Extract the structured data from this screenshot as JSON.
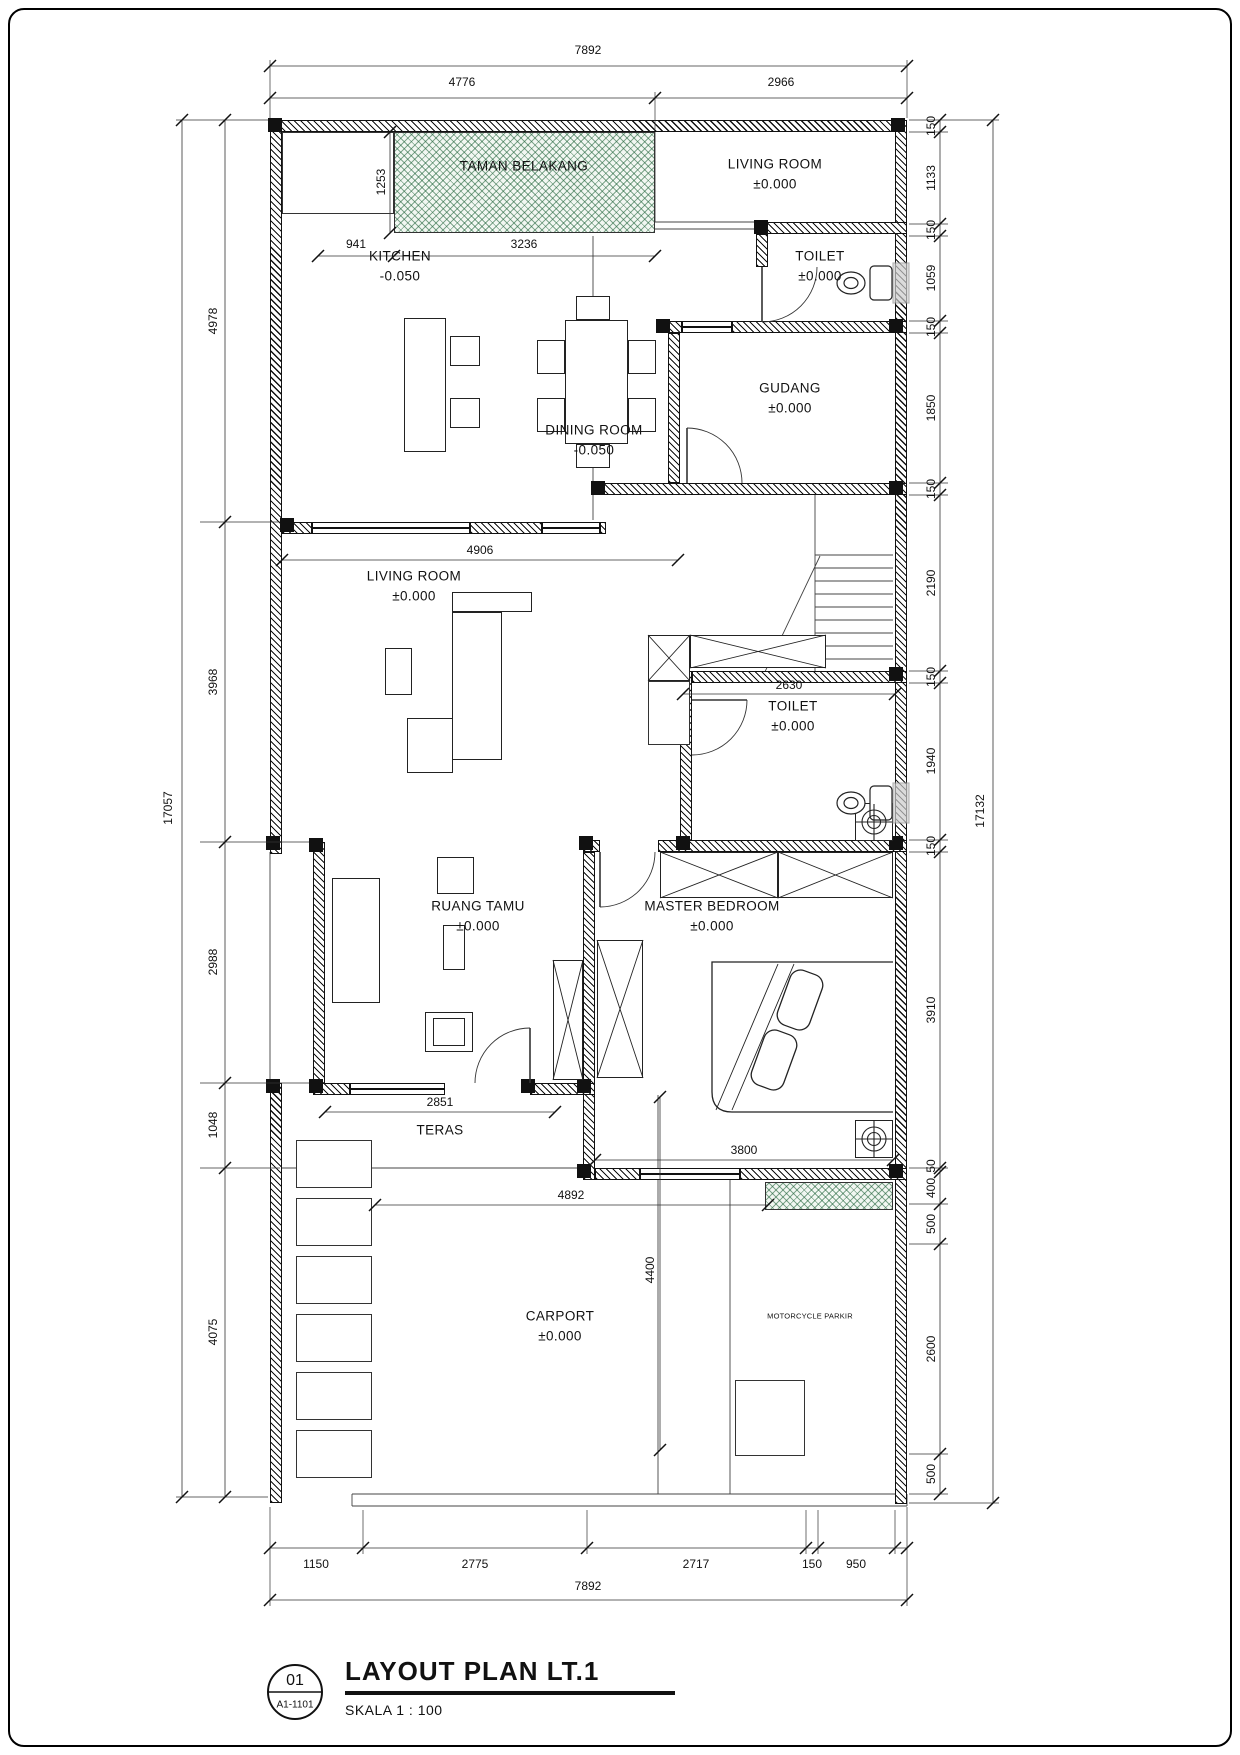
{
  "title_block": {
    "ref_number": "01",
    "sheet_code": "A1-1101",
    "title": "LAYOUT PLAN LT.1",
    "skala_label": "SKALA  1 : 100"
  },
  "colors": {
    "line": "#111111",
    "planter_green": "#1e6238"
  },
  "rooms": {
    "taman_belakang": {
      "name": "TAMAN BELAKANG"
    },
    "living_room_top": {
      "name": "LIVING ROOM",
      "level": "±0.000"
    },
    "toilet_top": {
      "name": "TOILET",
      "level": "±0.000"
    },
    "kitchen": {
      "name": "KITCHEN",
      "level": "-0.050"
    },
    "dining_room": {
      "name": "DINING ROOM",
      "level": "-0.050"
    },
    "gudang": {
      "name": "GUDANG",
      "level": "±0.000"
    },
    "living_room_mid": {
      "name": "LIVING ROOM",
      "level": "±0.000"
    },
    "toilet_mid": {
      "name": "TOILET",
      "level": "±0.000"
    },
    "ruang_tamu": {
      "name": "RUANG TAMU",
      "level": "±0.000"
    },
    "master_bedroom": {
      "name": "MASTER BEDROOM",
      "level": "±0.000"
    },
    "teras": {
      "name": "TERAS"
    },
    "carport": {
      "name": "CARPORT",
      "level": "±0.000"
    },
    "motorcycle": {
      "name": "MOTORCYCLE PARKIR"
    }
  },
  "dimensions": {
    "top": {
      "overall": "7892",
      "left": "4776",
      "right": "2966"
    },
    "left_chain": [
      "4978",
      "3968",
      "2988",
      "1048",
      "4075"
    ],
    "left_overall": "17057",
    "right_chain": [
      "150",
      "1133",
      "150",
      "1059",
      "150",
      "1850",
      "150",
      "2190",
      "150",
      "1940",
      "150",
      "3910",
      "50",
      "400",
      "500",
      "2600",
      "500"
    ],
    "right_overall": "17132",
    "bottom_chain": [
      "1150",
      "2775",
      "2717",
      "150",
      "950"
    ],
    "bottom_overall": "7892",
    "interior": {
      "taman_depth": "1253",
      "kitchen_left": "941",
      "taman_width": "3236",
      "living_width": "4906",
      "toilet_width": "2630",
      "teras_width": "2851",
      "master_width": "3800",
      "carport_width": "4892",
      "carport_depth": "4400"
    }
  }
}
